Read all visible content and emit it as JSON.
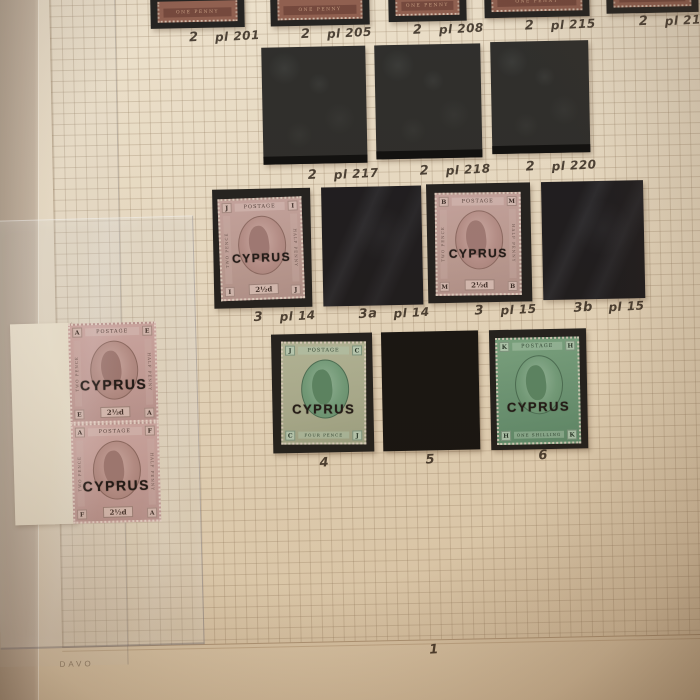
{
  "photo": {
    "album_brand": "DAVO",
    "page_number": "1"
  },
  "annotations": {
    "row1": [
      {
        "cat": "2",
        "plate": "pl 201"
      },
      {
        "cat": "2",
        "plate": "pl 205"
      },
      {
        "cat": "2",
        "plate": "pl 208"
      },
      {
        "cat": "2",
        "plate": "pl 215"
      },
      {
        "cat": "2",
        "plate": "pl 216"
      }
    ],
    "row2": [
      {
        "cat": "2",
        "plate": "pl 217"
      },
      {
        "cat": "2",
        "plate": "pl 218"
      },
      {
        "cat": "2",
        "plate": "pl 220"
      }
    ],
    "row3": [
      {
        "cat": "3",
        "plate": "pl 14"
      },
      {
        "cat": "3a",
        "plate": "pl 14"
      },
      {
        "cat": "3",
        "plate": "pl 15"
      },
      {
        "cat": "3b",
        "plate": "pl 15"
      }
    ],
    "row4": [
      {
        "cat": "4"
      },
      {
        "cat": "5"
      },
      {
        "cat": "6"
      }
    ]
  },
  "stamps": {
    "overprint": "CYPRUS",
    "row1_text": "ONE PENNY",
    "row3_left": {
      "top": "POSTAGE",
      "value": "2½d",
      "corners": [
        "J",
        "I",
        "I",
        "J"
      ],
      "left": "TWO PENCE",
      "right": "HALF PENNY"
    },
    "row3_right": {
      "top": "POSTAGE",
      "value": "2½d",
      "corners": [
        "B",
        "M",
        "M",
        "B"
      ],
      "left": "TWO PENCE",
      "right": "HALF PENNY"
    },
    "row4_left": {
      "top": "POSTAGE",
      "bottom": "FOUR PENCE",
      "corners": [
        "J",
        "C",
        "C",
        "J"
      ]
    },
    "row4_right": {
      "top": "POSTAGE",
      "bottom": "ONE SHILLING",
      "corners": [
        "K",
        "H",
        "H",
        "K"
      ]
    },
    "pair_top": {
      "top": "POSTAGE",
      "value": "2½d",
      "corners": [
        "A",
        "E",
        "E",
        "A"
      ],
      "left": "TWO PENCE",
      "right": "HALF PENNY"
    },
    "pair_bottom": {
      "top": "POSTAGE",
      "value": "2½d",
      "corners": [
        "A",
        "F",
        "F",
        "A"
      ],
      "left": "TWO PENCE",
      "right": "HALF PENNY"
    }
  },
  "colors": {
    "mount-black": "#1a1917",
    "page-cream": "#e6d9c2",
    "stamp-mauve": "#bd9b97",
    "stamp-sage-green": "#a9ae90",
    "stamp-deep-green": "#639070",
    "stamp-red-brown": "#8a5848",
    "handwriting-ink": "#2e241a",
    "selvage-white": "#e9e2cf"
  }
}
